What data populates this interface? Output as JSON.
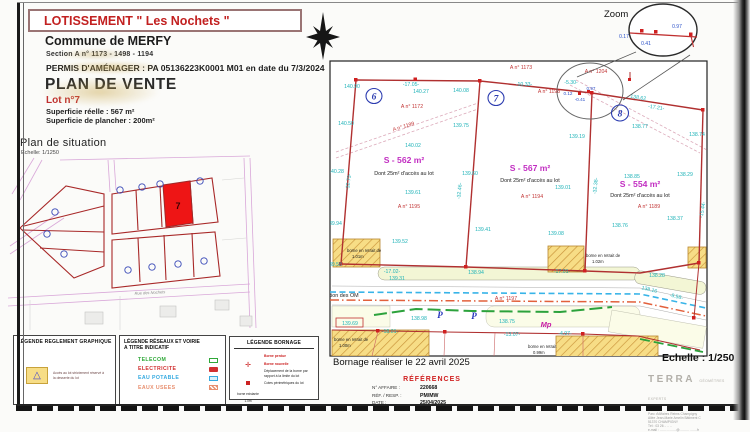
{
  "header": {
    "title": "LOTISSEMENT \" Les Nochets \"",
    "commune": "Commune de MERFY",
    "section": "Section A n° 1173 - 1498 - 1194",
    "permis": "PERMIS D'AMÉNAGER : PA 05136223K0001 M01 en date du 7/3/2024",
    "plan_title": "PLAN DE VENTE",
    "lot": "Lot n°7",
    "superficie_reelle": "Superficie réelle : 567 m²",
    "superficie_plancher": "Superficie de plancher :  200m²"
  },
  "situation": {
    "title": "Plan de situation",
    "scale": "Echelle: 1/1250",
    "lot_number": "7",
    "street_label": "Rue des Nochets"
  },
  "zoom_inset": {
    "title": "Zoom",
    "d1": "0.17",
    "d2": "0.41",
    "d3": "0.97"
  },
  "plan": {
    "lot_circles": [
      "6",
      "7",
      "8"
    ],
    "labels": [
      {
        "t": "140.90",
        "x": 352,
        "y": 88,
        "c": "t"
      },
      {
        "t": "-17.05-",
        "x": 411,
        "y": 86,
        "c": "t"
      },
      {
        "t": "140.27",
        "x": 421,
        "y": 93,
        "c": "t"
      },
      {
        "t": "140.08",
        "x": 461,
        "y": 92,
        "c": "t"
      },
      {
        "t": "-10.33-",
        "x": 524,
        "y": 86,
        "c": "t"
      },
      {
        "t": "140.50",
        "x": 346,
        "y": 125,
        "c": "t"
      },
      {
        "t": "139.75",
        "x": 461,
        "y": 127,
        "c": "t"
      },
      {
        "t": "140.02",
        "x": 413,
        "y": 147,
        "c": "t"
      },
      {
        "t": "139.61",
        "x": 413,
        "y": 194,
        "c": "t"
      },
      {
        "t": "139.52",
        "x": 400,
        "y": 243,
        "c": "t"
      },
      {
        "t": "140.28",
        "x": 336,
        "y": 173,
        "c": "t"
      },
      {
        "t": "-32.73-",
        "x": 350,
        "y": 182,
        "c": "t",
        "r": -83
      },
      {
        "t": "139.94",
        "x": 334,
        "y": 225,
        "c": "t"
      },
      {
        "t": "139.58",
        "x": 334,
        "y": 266,
        "c": "t"
      },
      {
        "t": "139.60",
        "x": 470,
        "y": 175,
        "c": "t"
      },
      {
        "t": "-32.46-",
        "x": 461,
        "y": 191,
        "c": "t",
        "r": -85
      },
      {
        "t": "139.41",
        "x": 483,
        "y": 231,
        "c": "t"
      },
      {
        "t": "-17.02-",
        "x": 392,
        "y": 273,
        "c": "t"
      },
      {
        "t": "139.31",
        "x": 397,
        "y": 280,
        "c": "t"
      },
      {
        "t": "138.94",
        "x": 476,
        "y": 274,
        "c": "t"
      },
      {
        "t": "-17.01-",
        "x": 562,
        "y": 273,
        "c": "t"
      },
      {
        "t": "-5.30-",
        "x": 571,
        "y": 84,
        "c": "t"
      },
      {
        "t": "138.62",
        "x": 638,
        "y": 99,
        "c": "t",
        "r": 9
      },
      {
        "t": "-17.21-",
        "x": 656,
        "y": 109,
        "c": "t",
        "r": 9
      },
      {
        "t": "138.77",
        "x": 640,
        "y": 128,
        "c": "t"
      },
      {
        "t": "139.19",
        "x": 577,
        "y": 138,
        "c": "t"
      },
      {
        "t": "138.74",
        "x": 697,
        "y": 136,
        "c": "t"
      },
      {
        "t": "139.01",
        "x": 563,
        "y": 189,
        "c": "t"
      },
      {
        "t": "138.85",
        "x": 632,
        "y": 178,
        "c": "t"
      },
      {
        "t": "138.29",
        "x": 685,
        "y": 176,
        "c": "t"
      },
      {
        "t": "-32.38-",
        "x": 597,
        "y": 186,
        "c": "t",
        "r": -85
      },
      {
        "t": "138.37",
        "x": 675,
        "y": 220,
        "c": "t"
      },
      {
        "t": "138.76",
        "x": 620,
        "y": 227,
        "c": "t"
      },
      {
        "t": "139.08",
        "x": 556,
        "y": 235,
        "c": "t"
      },
      {
        "t": "-15.44-",
        "x": 704,
        "y": 210,
        "c": "t",
        "r": -80
      },
      {
        "t": "138.28",
        "x": 657,
        "y": 277,
        "c": "t"
      },
      {
        "t": "138.16",
        "x": 649,
        "y": 291,
        "c": "t",
        "r": 14
      },
      {
        "t": "-8.58-",
        "x": 676,
        "y": 298,
        "c": "t",
        "r": 14
      },
      {
        "t": "138.98",
        "x": 419,
        "y": 320,
        "c": "t"
      },
      {
        "t": "138.75",
        "x": 507,
        "y": 323,
        "c": "t"
      },
      {
        "t": "-18.01-",
        "x": 390,
        "y": 333,
        "c": "t"
      },
      {
        "t": "-13.07-",
        "x": 512,
        "y": 336,
        "c": "t"
      },
      {
        "t": "139.69",
        "x": 350,
        "y": 325,
        "c": "t"
      },
      {
        "t": "-4.97-",
        "x": 565,
        "y": 335,
        "c": "t"
      },
      {
        "t": "A n° 1173",
        "x": 521,
        "y": 69,
        "c": "p"
      },
      {
        "t": "A n° 1198",
        "x": 549,
        "y": 93,
        "c": "p"
      },
      {
        "t": "A n° 1172",
        "x": 412,
        "y": 108,
        "c": "p"
      },
      {
        "t": "A n° 1199",
        "x": 404,
        "y": 128,
        "c": "p",
        "r": -17
      },
      {
        "t": "A n° 1195",
        "x": 409,
        "y": 208,
        "c": "p"
      },
      {
        "t": "A n° 1194",
        "x": 532,
        "y": 198,
        "c": "p"
      },
      {
        "t": "A n° 1189",
        "x": 649,
        "y": 208,
        "c": "p"
      },
      {
        "t": "A n° 1204",
        "x": 596,
        "y": 73,
        "c": "p"
      },
      {
        "t": "A n° 1197",
        "x": 506,
        "y": 300,
        "c": "p"
      },
      {
        "t": "S - 562 m²",
        "x": 404,
        "y": 163,
        "c": "s"
      },
      {
        "t": "S - 567 m²",
        "x": 530,
        "y": 171,
        "c": "s"
      },
      {
        "t": "S - 554 m²",
        "x": 640,
        "y": 187,
        "c": "s"
      },
      {
        "t": "Dont 25m² d'accès au lot",
        "x": 404,
        "y": 175,
        "c": "a"
      },
      {
        "t": "Dont 25m² d'accès au lot",
        "x": 530,
        "y": 182,
        "c": "a"
      },
      {
        "t": "Dont 25m² d'accès au lot",
        "x": 640,
        "y": 197,
        "c": "a"
      },
      {
        "t": "0.12",
        "x": 568,
        "y": 95,
        "c": "b"
      },
      {
        "t": "0.97",
        "x": 591,
        "y": 90,
        "c": "b"
      },
      {
        "t": "-0.41",
        "x": 580,
        "y": 101,
        "c": "b"
      },
      {
        "t": "Mp",
        "x": 546,
        "y": 327,
        "c": "m"
      },
      {
        "t": "P",
        "x": 440,
        "y": 318,
        "c": "P"
      },
      {
        "t": "P",
        "x": 474,
        "y": 319,
        "c": "P"
      },
      {
        "t": "borne en retrait de",
        "x": 347,
        "y": 252,
        "c": "n"
      },
      {
        "t": "1.01m",
        "x": 352,
        "y": 258,
        "c": "n"
      },
      {
        "t": "borne en retrait de",
        "x": 586,
        "y": 257,
        "c": "n"
      },
      {
        "t": "1.02m",
        "x": 592,
        "y": 263,
        "c": "n"
      },
      {
        "t": "borne en retrait de",
        "x": 334,
        "y": 341,
        "c": "n"
      },
      {
        "t": "1.00m",
        "x": 339,
        "y": 347,
        "c": "n"
      },
      {
        "t": "borne en retrait",
        "x": 528,
        "y": 348,
        "c": "n"
      },
      {
        "t": "0.99m",
        "x": 533,
        "y": 354,
        "c": "n"
      },
      {
        "t": "Présentation des OM",
        "x": 308,
        "y": 297,
        "c": "o"
      }
    ]
  },
  "bornage_note": "Bornage réaliser le 22 avril 2025",
  "scale_main": "Echelle : 1/250",
  "references": {
    "title": "RÉFÉRENCES",
    "rows": [
      {
        "label": "N° AFFAIRE :",
        "value": "220668"
      },
      {
        "label": "RÉF. / RESP. :",
        "value": "PM/MW"
      },
      {
        "label": "DATE :",
        "value": "25/04/2025"
      }
    ]
  },
  "firm": {
    "name": "TERRA",
    "tagline": "GÉOMÈTRES EXPERTS",
    "city": "REIMS",
    "address": [
      "Parc d'Affaires Reims Champigny",
      "Allée Jean-Marie Amelin   Bâtiment C",
      "51370   CHAMPIGNY",
      "Tél : 03 26 .. .. ..",
      "e-mail : ……………@…………….fr"
    ]
  },
  "legends": {
    "graphic": {
      "title": "LÉGENDE REGLEMENT GRAPHIQUE",
      "item": "Accès au lot strictement réservé à la desserte du lot"
    },
    "networks": {
      "title1": "LÉGENDE RÉSEAUX ET VOIRIE",
      "title2": "A TITRE INDICATIF",
      "items": [
        {
          "label": "TELECOM",
          "color": "#2fa838"
        },
        {
          "label": "ELECTRICITE",
          "color": "#d03030"
        },
        {
          "label": "EAU  POTABLE",
          "color": "#35aae0"
        },
        {
          "label": "EAUX  USEES",
          "color": "#e89070"
        }
      ]
    },
    "bornage": {
      "title": "LÉGENDE BORNAGE",
      "right": [
        {
          "t": "Borne perdue"
        },
        {
          "t": "Borne nouvelle"
        },
        {
          "t": "Déplacement de la borne par rapport à la limite du lot"
        },
        {
          "t": "Cotes périmétriques du lot"
        }
      ],
      "left": [
        "borne existante",
        "1.0m",
        "- 13.06 -"
      ]
    }
  },
  "colors": {
    "level_teal": "#1fb3b8",
    "parcel_red": "#c23535",
    "surface_magenta": "#c22ec2",
    "boundary_red": "#b03030",
    "lot_fill_red": "#ee1515",
    "water_blue": "#38b4e8",
    "sewer_orange": "#e2603c",
    "telecom_green": "#2ca23c",
    "hatch_yellow": "#f7dd86"
  }
}
